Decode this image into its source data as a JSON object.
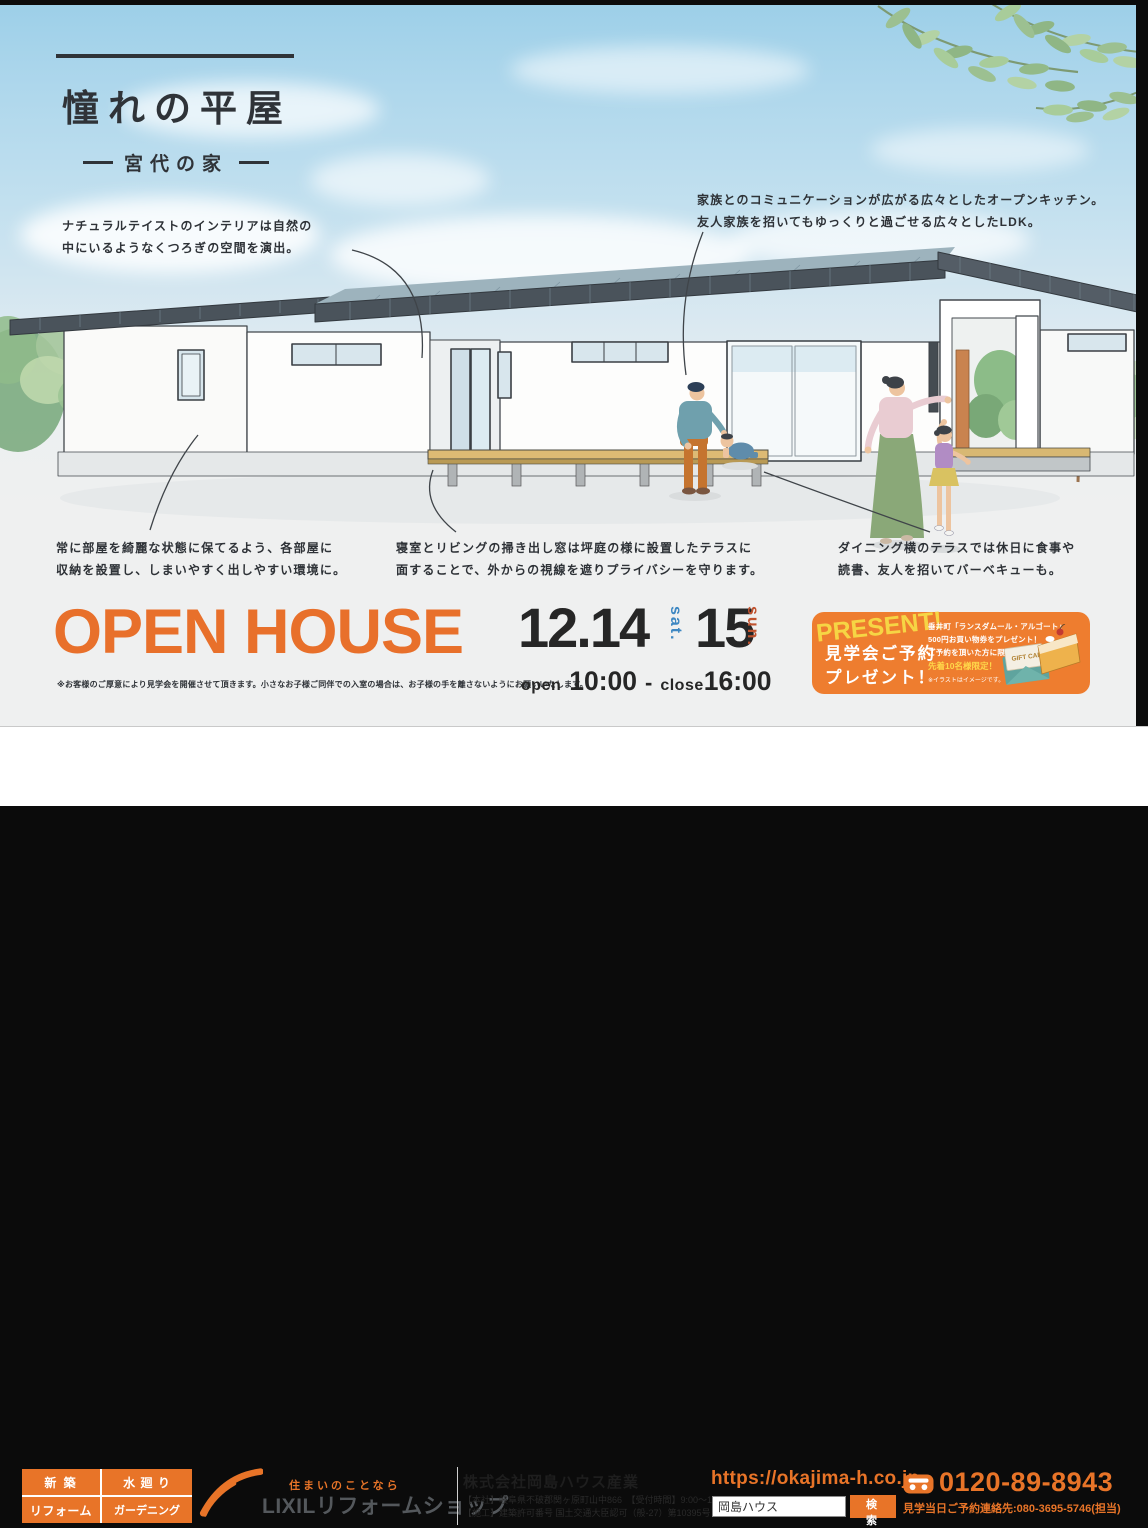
{
  "title": {
    "main": "憧れの平屋",
    "sub": "宮代の家"
  },
  "annotations": {
    "interior": "ナチュラルテイストのインテリアは自然の\n中にいるようなくつろぎの空間を演出。",
    "kitchen": "家族とのコミュニケーションが広がる広々としたオープンキッチン。\n友人家族を招いてもゆっくりと過ごせる広々としたLDK。",
    "storage": "常に部屋を綺麗な状態に保てるよう、各部屋に\n収納を設置し、しまいやすく出しやすい環境に。",
    "privacy": "寝室とリビングの掃き出し窓は坪庭の様に設置したテラスに\n面することで、外からの視線を遮りプライバシーを守ります。",
    "terrace": "ダイニング横のテラスでは休日に食事や\n読書、友人を招いてバーベキューも。"
  },
  "event": {
    "heading": "OPEN HOUSE",
    "disclaimer": "※お客様のご厚意により見学会を開催させて頂きます。小さなお子様ご同伴での入室の場合は、お子様の手を離さないようにお願いいたします。",
    "date1": "12.14",
    "date1_day": "sat.",
    "date2": "15",
    "date2_day": "sun.",
    "open_label": "open",
    "open_time": "10:00",
    "separator": "-",
    "close_label": "close",
    "close_time": "16:00"
  },
  "present": {
    "badge": "PRESENT!",
    "title": "見学会ご予約\nプレゼント！",
    "line1": "垂井町「ランスダムール・アルゴート」",
    "line2": "500円お買い物券をプレゼント！",
    "line3": "ご予約を頂いた方に限り",
    "highlight": "先着10名様限定！",
    "note": "※イラストはイメージです。",
    "gift_card": "GIFT CARD"
  },
  "footer": {
    "services": [
      "新 築",
      "水 廻 り",
      "リフォーム",
      "ガーデニング"
    ],
    "tagline": "住まいのことなら",
    "brand": "LIXILリフォームショップ",
    "company": "株式会社岡島ハウス産業",
    "company_line1": "【本社】岐阜県不破郡関ヶ原町山中866　【受付時間】9:00～17:00",
    "company_line2": "【施工】建築許可番号 国土交通大臣認可（般-27）第10395号",
    "url": "https://okajima-h.co.jp",
    "search_value": "岡島ハウス",
    "search_button": "検 索",
    "phone": "0120-89-8943",
    "contact": "見学当日ご予約連絡先:080-3695-5746(担当)"
  },
  "colors": {
    "accent_orange": "#e87428",
    "open_house_orange": "#e8702b",
    "present_box_orange": "#ee7d2f",
    "sat_blue": "#3d87c2",
    "sun_red": "#c0532f",
    "sky_blue": "#9ccfe8",
    "ground_gray": "#eff0f0"
  }
}
